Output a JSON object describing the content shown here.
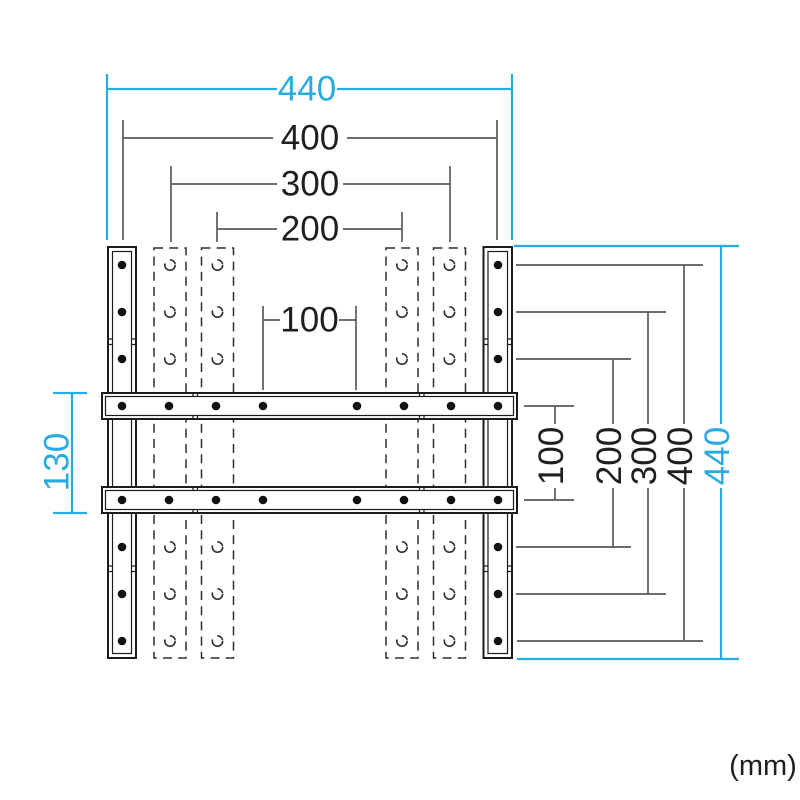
{
  "unit_note": "(mm)",
  "colors": {
    "accent_cyan": "#29ABE2",
    "dimension_line_gray": "#5A5A5A",
    "part_outline_black": "#1B1B1B",
    "label_text": "#1F1F1F"
  },
  "dimensions": {
    "top_widths": [
      {
        "id": "outer-width-440",
        "label": "440",
        "accent": true
      },
      {
        "id": "hole-width-400",
        "label": "400",
        "accent": false
      },
      {
        "id": "hole-width-300",
        "label": "300",
        "accent": false
      },
      {
        "id": "hole-width-200",
        "label": "200",
        "accent": false
      },
      {
        "id": "hole-width-100",
        "label": "100",
        "accent": false
      }
    ],
    "left_heights": [
      {
        "id": "crossbar-outer-height-130",
        "label": "130",
        "accent": true
      }
    ],
    "right_heights": [
      {
        "id": "hole-height-100",
        "label": "100",
        "accent": false
      },
      {
        "id": "hole-height-200",
        "label": "200",
        "accent": false
      },
      {
        "id": "hole-height-300",
        "label": "300",
        "accent": false
      },
      {
        "id": "hole-height-400",
        "label": "400",
        "accent": false
      },
      {
        "id": "outer-height-440",
        "label": "440",
        "accent": true
      }
    ]
  }
}
